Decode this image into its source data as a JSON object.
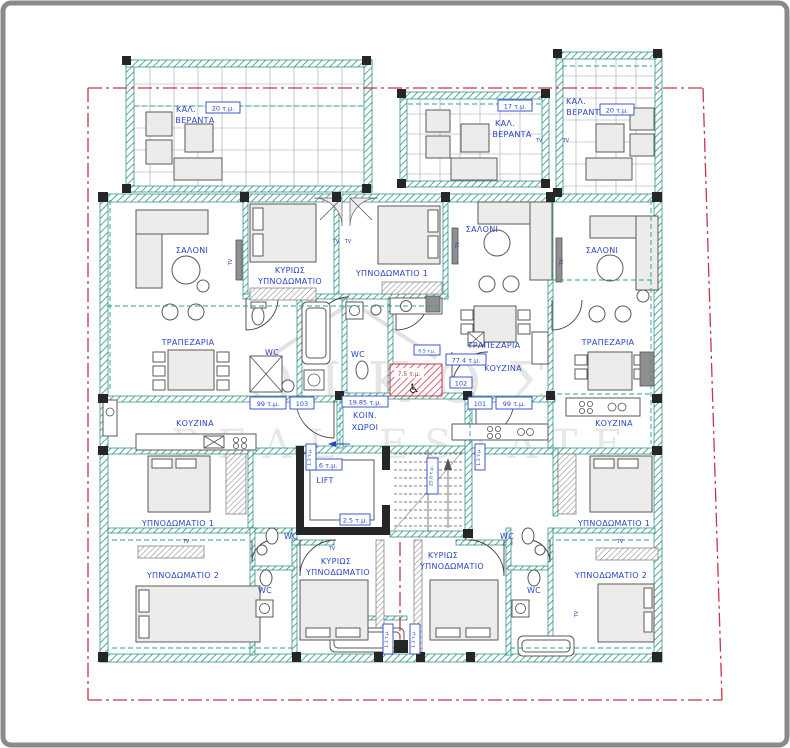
{
  "colors": {
    "wall_teal": "#2f9488",
    "wall_dark": "#262626",
    "label_blue": "#2846c8",
    "boundary_red": "#c5374a",
    "furniture_fill": "#ececea",
    "hatch_gray": "#8a8a8a",
    "watermark_gray": "#9a9a9a"
  },
  "watermark": {
    "line1": "ΟΙΚΟΣ",
    "line2": "REAL ESTATE"
  },
  "verandas": {
    "left": {
      "name_line1": "ΚΑΛ.",
      "name_line2": "ΒΕΡΑΝΤΑ",
      "area": "20 τ.μ."
    },
    "middle": {
      "name_line1": "ΚΑΛ.",
      "name_line2": "ΒΕΡΑΝΤΑ",
      "area": "17 τ.μ."
    },
    "right": {
      "name_line1": "ΚΑΛ.",
      "name_line2": "ΒΕΡΑΝΤΑ",
      "area": "20 τ.μ."
    }
  },
  "rooms": {
    "saloni": "ΣΑΛΟΝΙ",
    "trapezaria": "ΤΡΑΠΕΖΑΡΙΑ",
    "kouzina": "ΚΟΥΖΙΝΑ",
    "kyrios_line1": "ΚΥΡΙΩΣ",
    "kyrios_line2": "ΥΠΝΟΔΩΜΑΤΙΟ",
    "bedroom1": "ΥΠΝΟΔΩΜΑΤΙΟ 1",
    "bedroom2": "ΥΠΝΟΔΩΜΑΤΙΟ 2",
    "wc": "WC",
    "lift": "LIFT",
    "koin_line1": "ΚΟΙΝ.",
    "koin_line2": "ΧΩΡΟΙ",
    "tv": "TV"
  },
  "stamps": {
    "unit_101": "101",
    "unit_102": "102",
    "unit_103": "103",
    "area_101": "99 τ.μ.",
    "area_102": "77.4 τ.μ.",
    "area_103": "99 τ.μ.",
    "area_common": "19.85 τ.μ.",
    "area_lift": "3.6 τ.μ.",
    "area_stairs": "25.6 τ.μ.",
    "area_lobby": "2.5 τ.μ.",
    "area_wc_disabled": "7.5 τ.μ.",
    "area_sink": "0.5 τ.μ.",
    "area_shaft": "1.3 τ.μ.",
    "wheelchair_icon": "♿"
  }
}
